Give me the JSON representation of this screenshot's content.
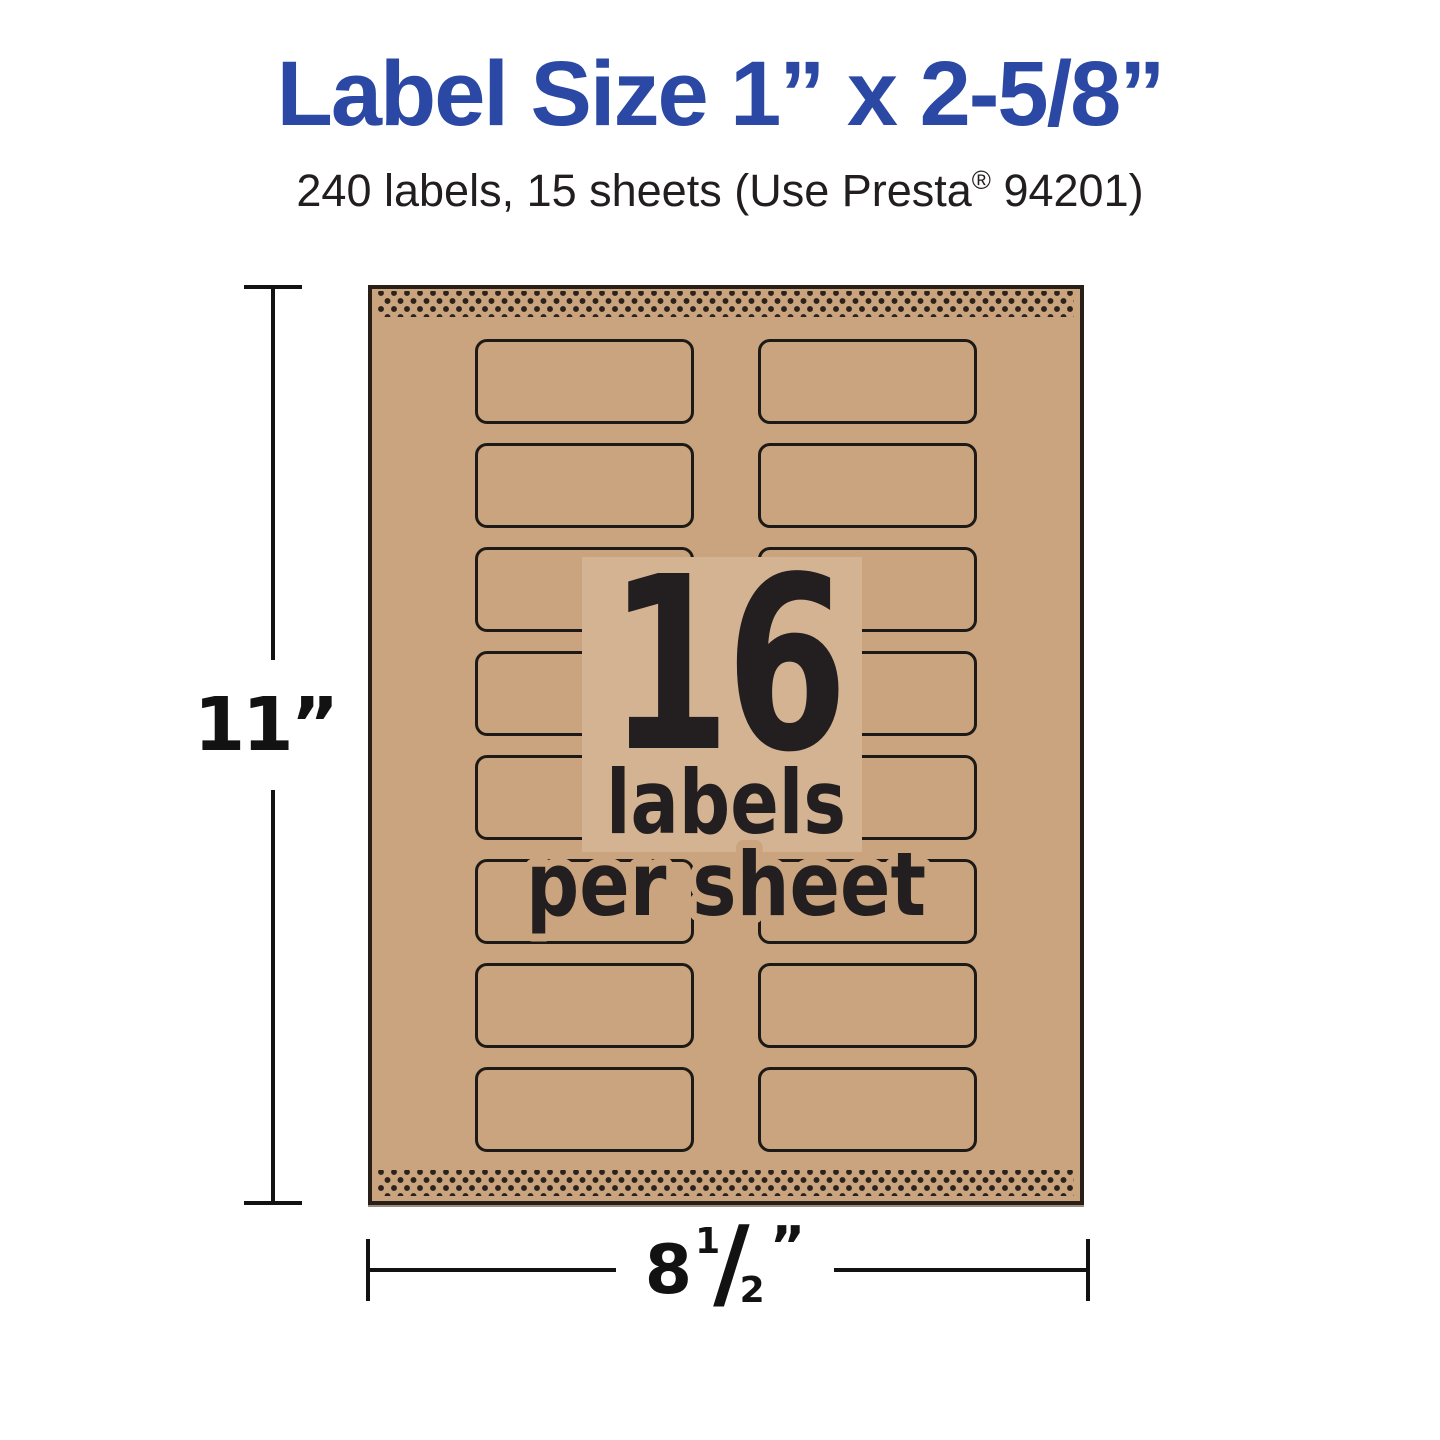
{
  "page": {
    "background_color": "#ffffff"
  },
  "header": {
    "title": "Label Size 1” x 2-5/8”",
    "title_color": "#2a48a4",
    "subtitle_prefix": "240 labels, 15 sheets (Use Presta",
    "subtitle_reg_mark": "®",
    "subtitle_suffix": " 94201)"
  },
  "sheet": {
    "rows": 8,
    "columns": 2,
    "paper_color": "#c9a47e",
    "label_outline_color": "#1d1916",
    "perforation_color": "#2b221b",
    "center_overlay": {
      "count": "16",
      "line1": "labels",
      "line2": "per sheet",
      "ink_color": "#231f20",
      "panel_color": "#d4b392"
    }
  },
  "dimensions": {
    "height_label": "11”",
    "width_whole": "8",
    "width_numerator": "1",
    "width_slash": "/",
    "width_denominator": "2",
    "width_unit": "”"
  }
}
